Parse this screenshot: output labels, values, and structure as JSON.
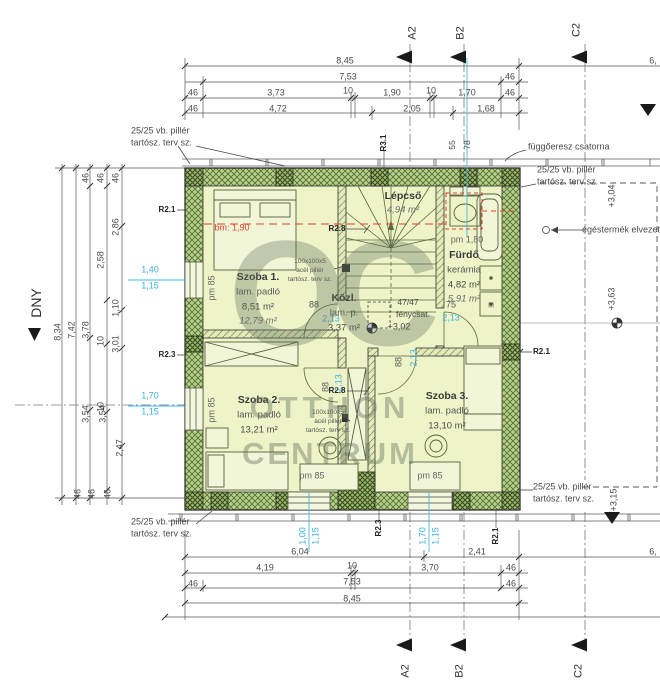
{
  "watermark": {
    "logo": "OC",
    "line1": "OTTHON",
    "line2": "CENTRUM"
  },
  "colors": {
    "cyan": "#3eb0e4",
    "red": "#e2402c",
    "wall_green": "#b9d08a",
    "room_fill": "#eef4c8",
    "dim_text": "#4a4a4a"
  },
  "rooms": [
    {
      "name": "Szoba 1.",
      "floor": "lam. padló",
      "area": "8,51 m²",
      "area_alt": "12,79 m²",
      "cx": 258,
      "cy": 277
    },
    {
      "name": "Közl.",
      "floor": "lam. p.",
      "area": "3,37 m²",
      "cx": 344,
      "cy": 298
    },
    {
      "name": "Lépcső",
      "area_alt": "4,94 m²",
      "cx": 403,
      "cy": 196
    },
    {
      "name": "Fürdő",
      "floor": "kerámia",
      "area": "4,82 m²",
      "area_alt": "5,91 m²",
      "cx": 464,
      "cy": 255
    },
    {
      "name": "Szoba 2.",
      "floor": "lam. padló",
      "area": "13,21 m²",
      "cx": 259,
      "cy": 400
    },
    {
      "name": "Szoba 3.",
      "floor": "lam. padló",
      "area": "13,10 m²",
      "cx": 447,
      "cy": 396
    }
  ],
  "labels": [
    {
      "t": "8,45",
      "x": 345,
      "y": 61,
      "n": "dim-top"
    },
    {
      "t": "6,",
      "x": 653,
      "y": 61,
      "n": "dim-top"
    },
    {
      "t": "7,53",
      "x": 348,
      "y": 77,
      "n": "dim-top"
    },
    {
      "t": "46",
      "x": 510,
      "y": 77,
      "n": "dim-top"
    },
    {
      "t": "46",
      "x": 193,
      "y": 93,
      "n": "dim-top"
    },
    {
      "t": "3,73",
      "x": 276,
      "y": 93,
      "n": "dim-top"
    },
    {
      "t": "10",
      "x": 348,
      "y": 91,
      "n": "dim-top"
    },
    {
      "t": "1,90",
      "x": 392,
      "y": 93,
      "n": "dim-top"
    },
    {
      "t": "10",
      "x": 431,
      "y": 91,
      "n": "dim-top"
    },
    {
      "t": "1,70",
      "x": 467,
      "y": 93,
      "n": "dim-top"
    },
    {
      "t": "46",
      "x": 510,
      "y": 93,
      "n": "dim-top"
    },
    {
      "t": "46",
      "x": 193,
      "y": 109,
      "n": "dim-top"
    },
    {
      "t": "4,72",
      "x": 278,
      "y": 109,
      "n": "dim-top"
    },
    {
      "t": "2,05",
      "x": 412,
      "y": 109,
      "n": "dim-top"
    },
    {
      "t": "1,68",
      "x": 486,
      "y": 109,
      "n": "dim-top"
    },
    {
      "t": "A2",
      "x": 413,
      "y": 33,
      "r": -90,
      "s": 11,
      "c": "#333",
      "n": "section-marker-a2-top"
    },
    {
      "t": "B2",
      "x": 461,
      "y": 33,
      "r": -90,
      "s": 11,
      "c": "#333",
      "n": "section-marker-b2-top"
    },
    {
      "t": "C2",
      "x": 577,
      "y": 30,
      "r": -90,
      "s": 11,
      "c": "#333",
      "n": "section-marker-c2-top"
    },
    {
      "t": "A2",
      "x": 406,
      "y": 671,
      "r": -90,
      "s": 11,
      "c": "#333",
      "n": "section-marker-a2-bottom"
    },
    {
      "t": "B2",
      "x": 460,
      "y": 671,
      "r": -90,
      "s": 11,
      "c": "#333",
      "n": "section-marker-b2-bottom"
    },
    {
      "t": "C2",
      "x": 579,
      "y": 671,
      "r": -90,
      "s": 11,
      "c": "#333",
      "n": "section-marker-c2-bottom"
    },
    {
      "t": "8,34",
      "x": 58,
      "y": 332,
      "r": -90,
      "n": "dim-left"
    },
    {
      "t": "7,42",
      "x": 72,
      "y": 330,
      "r": -90,
      "n": "dim-left"
    },
    {
      "t": "46",
      "x": 86,
      "y": 178,
      "r": -90,
      "n": "dim-left"
    },
    {
      "t": "46",
      "x": 101,
      "y": 178,
      "r": -90,
      "n": "dim-left"
    },
    {
      "t": "46",
      "x": 116,
      "y": 178,
      "r": -90,
      "n": "dim-left"
    },
    {
      "t": "2,86",
      "x": 116,
      "y": 227,
      "r": -90,
      "n": "dim-left"
    },
    {
      "t": "2,58",
      "x": 101,
      "y": 260,
      "r": -90,
      "n": "dim-left"
    },
    {
      "t": "1,10",
      "x": 116,
      "y": 308,
      "r": -90,
      "n": "dim-left"
    },
    {
      "t": "3,78",
      "x": 86,
      "y": 330,
      "r": -90,
      "n": "dim-left"
    },
    {
      "t": "10",
      "x": 101,
      "y": 341,
      "r": -90,
      "n": "dim-left"
    },
    {
      "t": "3,01",
      "x": 116,
      "y": 344,
      "r": -90,
      "n": "dim-left"
    },
    {
      "t": "10",
      "x": 101,
      "y": 407,
      "r": -90,
      "n": "dim-left"
    },
    {
      "t": "3,54",
      "x": 86,
      "y": 414,
      "r": -90,
      "n": "dim-left"
    },
    {
      "t": "3,54",
      "x": 103,
      "y": 414,
      "r": -90,
      "n": "dim-left"
    },
    {
      "t": "2,47",
      "x": 120,
      "y": 448,
      "r": -90,
      "n": "dim-left"
    },
    {
      "t": "46",
      "x": 78,
      "y": 494,
      "r": -90,
      "n": "dim-left"
    },
    {
      "t": "46",
      "x": 92,
      "y": 494,
      "r": -90,
      "n": "dim-left"
    },
    {
      "t": "46",
      "x": 108,
      "y": 494,
      "r": -90,
      "n": "dim-left"
    },
    {
      "t": "DNY",
      "x": 36,
      "y": 303,
      "r": -90,
      "s": 14,
      "c": "#2e2e2e",
      "n": "orientation-label-dny"
    },
    {
      "t": "1,40",
      "x": 150,
      "y": 270,
      "c": "#3eb0e4",
      "n": "window-dim"
    },
    {
      "t": "1,15",
      "x": 150,
      "y": 286,
      "c": "#3eb0e4",
      "n": "window-dim"
    },
    {
      "t": "1,70",
      "x": 150,
      "y": 396,
      "c": "#3eb0e4",
      "n": "window-dim"
    },
    {
      "t": "1,15",
      "x": 150,
      "y": 412,
      "c": "#3eb0e4",
      "n": "window-dim"
    },
    {
      "t": "55",
      "x": 452,
      "y": 145,
      "r": -90,
      "s": 8.5,
      "n": "dim-top-small"
    },
    {
      "t": "78",
      "x": 467,
      "y": 145,
      "r": -90,
      "s": 8.5,
      "n": "dim-top-small"
    },
    {
      "t": "R3.1",
      "x": 384,
      "y": 143,
      "r": -90,
      "s": 8,
      "w": 700,
      "c": "#222",
      "n": "ref-label-r31"
    },
    {
      "t": "függőeresz csatorna",
      "x": 528,
      "y": 147,
      "a": "left",
      "n": "note-gutter"
    },
    {
      "t": "25/25 vb. pillér",
      "x": 537,
      "y": 170,
      "a": "left",
      "n": "note-pillar"
    },
    {
      "t": "tartósz. terv sz.",
      "x": 537,
      "y": 182,
      "a": "left",
      "n": "note-pillar"
    },
    {
      "t": "+3,04",
      "x": 612,
      "y": 196,
      "r": -90,
      "n": "level-label"
    },
    {
      "t": "égéstermék elvezetés",
      "x": 582,
      "y": 230,
      "a": "left",
      "n": "note-flue"
    },
    {
      "t": "+3,63",
      "x": 612,
      "y": 299,
      "r": -90,
      "n": "level-label"
    },
    {
      "t": "R2.1",
      "x": 533,
      "y": 352,
      "a": "left",
      "s": 8,
      "w": 700,
      "c": "#222",
      "n": "ref-label-r21"
    },
    {
      "t": "25/25 vb. pillér",
      "x": 131,
      "y": 131,
      "a": "left",
      "n": "note-pillar"
    },
    {
      "t": "tartósz. terv sz.",
      "x": 131,
      "y": 143,
      "a": "left",
      "n": "note-pillar"
    },
    {
      "t": "25/25 vb. pillér",
      "x": 131,
      "y": 522,
      "a": "left",
      "n": "note-pillar"
    },
    {
      "t": "tartósz. terv sz.",
      "x": 131,
      "y": 534,
      "a": "left",
      "n": "note-pillar"
    },
    {
      "t": "25/25 vb. pillér",
      "x": 533,
      "y": 487,
      "a": "left",
      "n": "note-pillar"
    },
    {
      "t": "tartósz. terv sz.",
      "x": 533,
      "y": 499,
      "a": "left",
      "n": "note-pillar"
    },
    {
      "t": "+3,15",
      "x": 614,
      "y": 500,
      "r": -90,
      "n": "level-label"
    },
    {
      "t": "6,04",
      "x": 300,
      "y": 552,
      "n": "dim-bottom"
    },
    {
      "t": "2,41",
      "x": 477,
      "y": 552,
      "n": "dim-bottom"
    },
    {
      "t": "6,",
      "x": 653,
      "y": 552,
      "n": "dim-bottom"
    },
    {
      "t": "4,19",
      "x": 265,
      "y": 568,
      "n": "dim-bottom"
    },
    {
      "t": "10",
      "x": 352,
      "y": 566,
      "n": "dim-bottom"
    },
    {
      "t": "3,70",
      "x": 430,
      "y": 568,
      "n": "dim-bottom"
    },
    {
      "t": "46",
      "x": 511,
      "y": 568,
      "n": "dim-bottom"
    },
    {
      "t": "46",
      "x": 193,
      "y": 584,
      "n": "dim-bottom"
    },
    {
      "t": "7,53",
      "x": 352,
      "y": 582,
      "n": "dim-bottom"
    },
    {
      "t": "46",
      "x": 511,
      "y": 584,
      "n": "dim-bottom"
    },
    {
      "t": "8,45",
      "x": 352,
      "y": 599,
      "n": "dim-bottom"
    },
    {
      "t": "R2.3",
      "x": 379,
      "y": 528,
      "r": -90,
      "s": 8,
      "w": 700,
      "c": "#222",
      "n": "ref-label-r23"
    },
    {
      "t": "R2.1",
      "x": 496,
      "y": 536,
      "r": -90,
      "s": 8,
      "w": 700,
      "c": "#222",
      "n": "ref-label-r21"
    },
    {
      "t": "1,00",
      "x": 303,
      "y": 536,
      "r": -90,
      "c": "#3eb0e4",
      "n": "window-dim"
    },
    {
      "t": "1,15",
      "x": 316,
      "y": 536,
      "r": -90,
      "c": "#3eb0e4",
      "n": "window-dim"
    },
    {
      "t": "1,70",
      "x": 423,
      "y": 536,
      "r": -90,
      "c": "#3eb0e4",
      "n": "window-dim"
    },
    {
      "t": "1,15",
      "x": 436,
      "y": 536,
      "r": -90,
      "c": "#3eb0e4",
      "n": "window-dim"
    },
    {
      "t": "R2.1",
      "x": 167,
      "y": 210,
      "s": 8,
      "w": 700,
      "c": "#222",
      "n": "ref-label-r21"
    },
    {
      "t": "R2.3",
      "x": 167,
      "y": 355,
      "s": 8,
      "w": 700,
      "c": "#222",
      "n": "ref-label-r23"
    },
    {
      "t": "bm: 1,90",
      "x": 232,
      "y": 228,
      "c": "#e2402c",
      "n": "height-line-label"
    },
    {
      "t": "R2.8",
      "x": 337,
      "y": 229,
      "s": 8,
      "w": 700,
      "c": "#222",
      "n": "ref-label-r28"
    },
    {
      "t": "R2.8",
      "x": 337,
      "y": 391,
      "s": 8,
      "w": 700,
      "c": "#222",
      "n": "ref-label-r28"
    },
    {
      "t": "pm 85",
      "x": 212,
      "y": 288,
      "r": -90,
      "c": "#666",
      "n": "parapet-label"
    },
    {
      "t": "pm 85",
      "x": 212,
      "y": 410,
      "r": -90,
      "c": "#666",
      "n": "parapet-label"
    },
    {
      "t": "pm 85",
      "x": 312,
      "y": 476,
      "c": "#666",
      "n": "parapet-label"
    },
    {
      "t": "pm 85",
      "x": 430,
      "y": 476,
      "c": "#666",
      "n": "parapet-label"
    },
    {
      "t": "pm 1,80",
      "x": 467,
      "y": 240,
      "c": "#666",
      "n": "parapet-label"
    },
    {
      "t": "88",
      "x": 314,
      "y": 305,
      "c": "#555",
      "n": "door-dim"
    },
    {
      "t": "2,13",
      "x": 331,
      "y": 319,
      "c": "#3eb0e4",
      "n": "door-dim"
    },
    {
      "t": "75",
      "x": 451,
      "y": 305,
      "c": "#555",
      "n": "door-dim"
    },
    {
      "t": "2,13",
      "x": 451,
      "y": 318,
      "c": "#3eb0e4",
      "n": "door-dim"
    },
    {
      "t": "88",
      "x": 326,
      "y": 387,
      "r": -90,
      "c": "#555",
      "n": "door-dim"
    },
    {
      "t": "2,13",
      "x": 339,
      "y": 383,
      "r": -90,
      "c": "#3eb0e4",
      "n": "door-dim"
    },
    {
      "t": "88",
      "x": 399,
      "y": 362,
      "r": -90,
      "c": "#555",
      "n": "door-dim"
    },
    {
      "t": "2,13",
      "x": 414,
      "y": 358,
      "r": -90,
      "c": "#3eb0e4",
      "n": "door-dim"
    },
    {
      "t": "100x100x5",
      "x": 310,
      "y": 262,
      "s": 6.5,
      "c": "#555",
      "n": "note-steel-pillar"
    },
    {
      "t": "acél pillér",
      "x": 310,
      "y": 271,
      "s": 6.5,
      "c": "#555",
      "n": "note-steel-pillar"
    },
    {
      "t": "tartósz. terv sz.",
      "x": 310,
      "y": 280,
      "s": 6.5,
      "c": "#555",
      "n": "note-steel-pillar"
    },
    {
      "t": "100x100x5",
      "x": 328,
      "y": 413,
      "s": 6.5,
      "c": "#555",
      "n": "note-steel-pillar"
    },
    {
      "t": "acél pillér",
      "x": 328,
      "y": 422,
      "s": 6.5,
      "c": "#555",
      "n": "note-steel-pillar"
    },
    {
      "t": "tartósz. terv sz.",
      "x": 328,
      "y": 431,
      "s": 6.5,
      "c": "#555",
      "n": "note-steel-pillar"
    },
    {
      "t": "47/47",
      "x": 408,
      "y": 302,
      "s": 8.5,
      "n": "note-lightshaft"
    },
    {
      "t": "fénycsat.",
      "x": 413,
      "y": 314,
      "s": 8.5,
      "n": "note-lightshaft"
    },
    {
      "t": "+3,02",
      "x": 399,
      "y": 327,
      "n": "level-label"
    },
    {
      "t": "M",
      "x": 491,
      "y": 306,
      "s": 7,
      "c": "#555",
      "n": "washing-machine-label"
    }
  ]
}
